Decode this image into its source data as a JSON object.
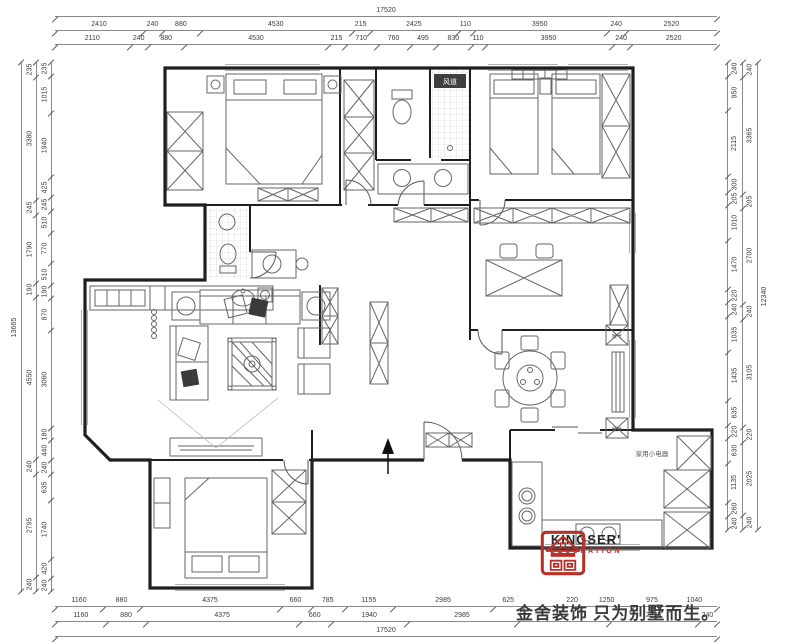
{
  "dims": {
    "top": {
      "total": [
        {
          "t": "17520"
        }
      ],
      "row1": [
        {
          "t": "2410"
        },
        {
          "t": "240"
        },
        {
          "t": "880"
        },
        {
          "t": "4530"
        },
        {
          "t": "215"
        },
        {
          "t": "2425"
        },
        {
          "t": "110"
        },
        {
          "t": "3950"
        },
        {
          "t": "240"
        },
        {
          "t": "2520"
        }
      ],
      "row2": [
        {
          "t": "2110"
        },
        {
          "t": "240"
        },
        {
          "t": "880"
        },
        {
          "t": "4530"
        },
        {
          "t": "215"
        },
        {
          "t": "710"
        },
        {
          "t": "760"
        },
        {
          "t": "495"
        },
        {
          "t": "830"
        },
        {
          "t": "110"
        },
        {
          "t": "3950"
        },
        {
          "t": "240"
        },
        {
          "t": "2520"
        }
      ]
    },
    "bottom": {
      "row1": [
        {
          "t": "1160"
        },
        {
          "t": "880"
        },
        {
          "t": "4375"
        },
        {
          "t": "660"
        },
        {
          "t": "785"
        },
        {
          "t": "1155"
        },
        {
          "t": "2985"
        },
        {
          "t": "625"
        },
        {
          "t": "",
          "v": 1410
        },
        {
          "t": "220"
        },
        {
          "t": "1250"
        },
        {
          "t": "975"
        },
        {
          "t": "1040"
        }
      ],
      "row2": [
        {
          "t": "1160"
        },
        {
          "t": "880"
        },
        {
          "t": "4375"
        },
        {
          "t": "660"
        },
        {
          "t": "1940"
        },
        {
          "t": "2985"
        },
        {
          "t": "",
          "v": 2955
        },
        {
          "t": "2325"
        },
        {
          "t": "240"
        }
      ],
      "total": [
        {
          "t": "17520"
        }
      ]
    },
    "left": {
      "total": [
        {
          "t": "13665"
        }
      ],
      "coarse": [
        {
          "t": "235"
        },
        {
          "t": "3380"
        },
        {
          "t": "245"
        },
        {
          "t": "1790"
        },
        {
          "t": "190"
        },
        {
          "t": "4550"
        },
        {
          "t": "240"
        },
        {
          "t": "2795"
        },
        {
          "t": "240"
        }
      ],
      "fine": [
        {
          "t": "235"
        },
        {
          "t": "1015"
        },
        {
          "t": "1940"
        },
        {
          "t": "425"
        },
        {
          "t": "245"
        },
        {
          "t": "510"
        },
        {
          "t": "770"
        },
        {
          "t": "510"
        },
        {
          "t": "190"
        },
        {
          "t": "870"
        },
        {
          "t": "3060"
        },
        {
          "t": "180"
        },
        {
          "t": "440"
        },
        {
          "t": "240"
        },
        {
          "t": "635"
        },
        {
          "t": "1740"
        },
        {
          "t": "420"
        },
        {
          "t": "240"
        }
      ]
    },
    "right": {
      "fine": [
        {
          "t": "240"
        },
        {
          "t": "950"
        },
        {
          "t": "2115"
        },
        {
          "t": "300"
        },
        {
          "t": "205"
        },
        {
          "t": "1010"
        },
        {
          "t": "1470"
        },
        {
          "t": "220"
        },
        {
          "t": "240"
        },
        {
          "t": "1035"
        },
        {
          "t": "1435"
        },
        {
          "t": "635"
        },
        {
          "t": "220"
        },
        {
          "t": "630"
        },
        {
          "t": "1135"
        },
        {
          "t": "260"
        },
        {
          "t": "240"
        }
      ],
      "coarse": [
        {
          "t": "240"
        },
        {
          "t": "3365"
        },
        {
          "t": "205"
        },
        {
          "t": "2700"
        },
        {
          "t": "240"
        },
        {
          "t": "3105"
        },
        {
          "t": "220"
        },
        {
          "t": "2025"
        },
        {
          "t": "240"
        }
      ],
      "total": [
        {
          "t": "12340"
        }
      ]
    }
  },
  "plan": {
    "labels": {
      "vent": "风道",
      "appliances": "家用小电器",
      "radiator": "暖气"
    }
  },
  "logo": {
    "brand": "KINGSER'",
    "division": "DECORATION",
    "slogan": "金舍装饰 只为别墅而生。"
  }
}
